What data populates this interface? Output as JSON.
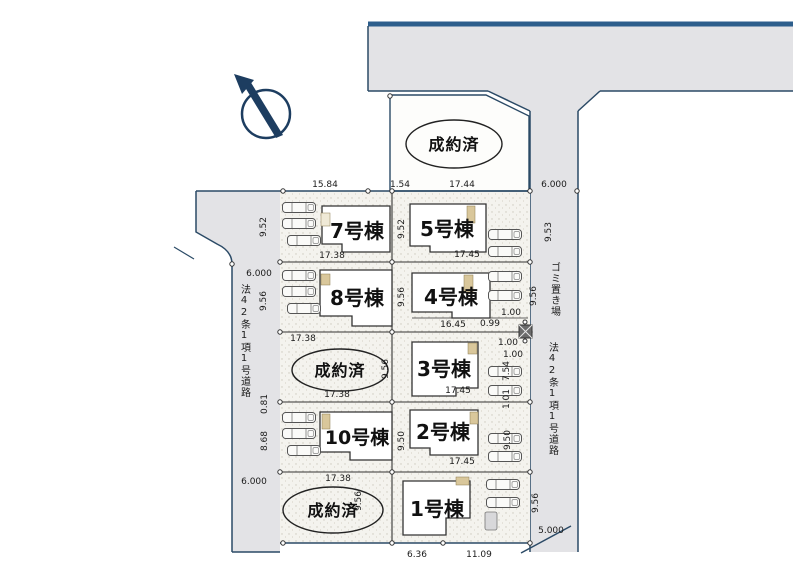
{
  "plan": {
    "sold_label": "成約済",
    "lots": {
      "b7": "7号棟",
      "b5": "5号棟",
      "b8": "8号棟",
      "b4": "4号棟",
      "b3": "3号棟",
      "b10": "10号棟",
      "b2": "2号棟",
      "b1": "1号棟"
    },
    "labels": {
      "road_left": "法42条1項1号道路",
      "road_right": "法42条1項1号道路",
      "garbage": "ゴミ置き場"
    },
    "dims": {
      "top_a": "15.84",
      "top_b": "1.54",
      "top_c": "17.44",
      "top_road_w": "6.000",
      "left_r1_h": "9.52",
      "left_road_w_top": "6.000",
      "left_r2_h": "9.56",
      "left_r4_h_a": "0.81",
      "left_r4_h_b": "8.68",
      "left_road_w_bottom": "6.000",
      "r1_wl": "17.38",
      "r1_wr": "17.45",
      "r1_hm": "9.52",
      "right_r1_h": "9.53",
      "r2_wl": "17.38",
      "r2_hm": "9.56",
      "r2_wr_a": "16.45",
      "r2_wr_b": "0.99",
      "r2_one": "1.00",
      "right_r2_h": "9.56",
      "r3_wl": "17.38",
      "r3_wr": "17.45",
      "r3_hm": "9.56",
      "r3_one_a": "1.00",
      "r3_one_b": "1.00",
      "right_r3_h_a": "7.54",
      "right_r3_h_b": "1.01",
      "r4_wl": "17.38",
      "r4_wr": "17.45",
      "r4_hm": "9.50",
      "right_r4_h": "9.50",
      "r5_hm": "9.56",
      "right_r5_h": "9.56",
      "bottom_a": "6.36",
      "bottom_b": "11.09",
      "right_road_w_bottom": "5.000"
    },
    "colors": {
      "road_fill": "#e3e3e6",
      "lot_fill": "#f4f3ee",
      "line_dark": "#2b4a66",
      "accent_tan": "#d9c79b"
    }
  }
}
